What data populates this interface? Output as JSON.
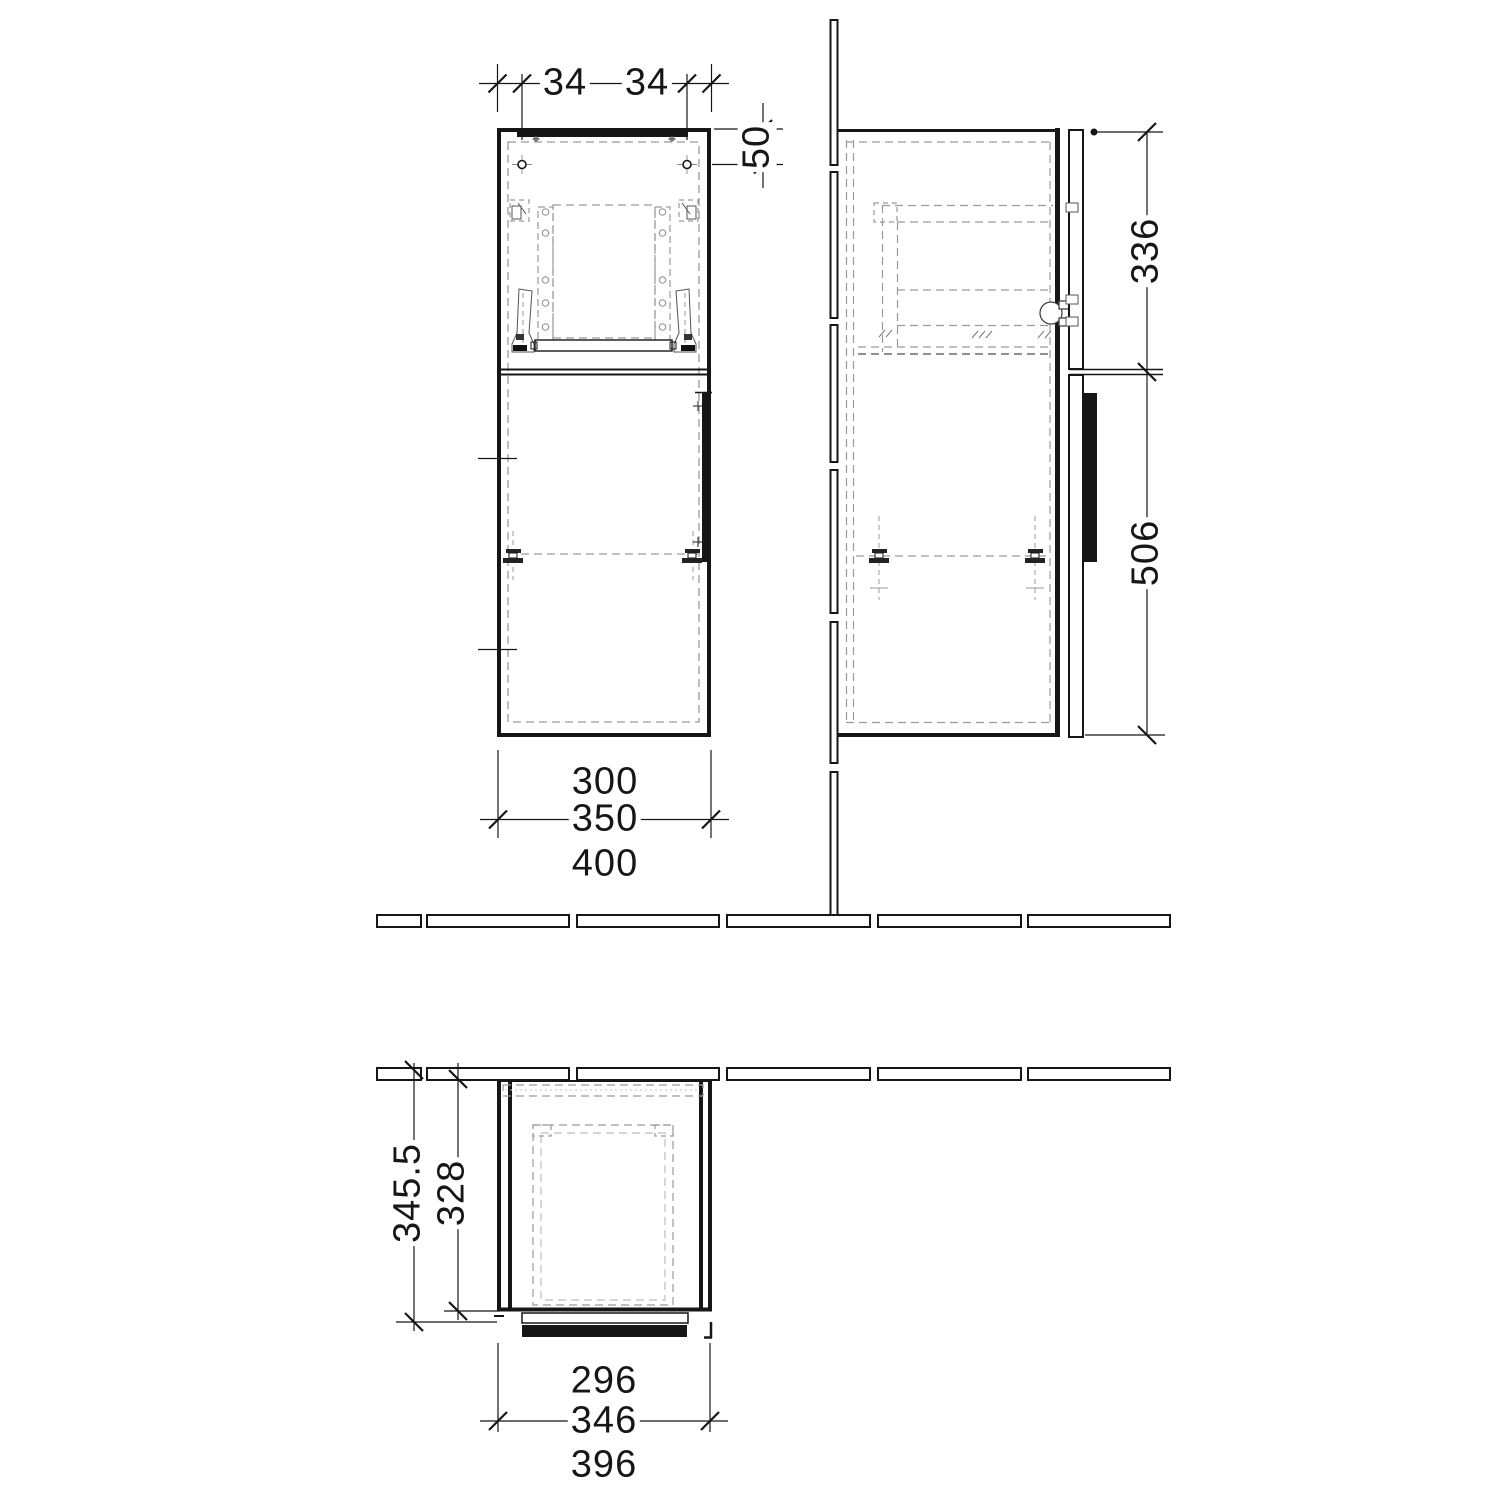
{
  "drawing": {
    "type": "furniture-dimension-drawing",
    "colors": {
      "line": "#161616",
      "dashed": "#9a9a9a",
      "background": "#ffffff"
    },
    "views": {
      "front": {
        "name": "front-elevation",
        "dims": {
          "top_hole_left": "34",
          "top_hole_right": "34",
          "right_hole_offset": "50",
          "bottom_inner": "300",
          "bottom_mid": "350",
          "bottom_outer": "400"
        }
      },
      "side": {
        "name": "side-elevation",
        "dims": {
          "upper_height": "336",
          "lower_height": "506"
        }
      },
      "plan": {
        "name": "top-plan",
        "dims": {
          "depth_outer": "345.5",
          "depth_inner": "328",
          "bottom_inner": "296",
          "bottom_mid": "346",
          "bottom_outer": "396"
        }
      }
    }
  }
}
